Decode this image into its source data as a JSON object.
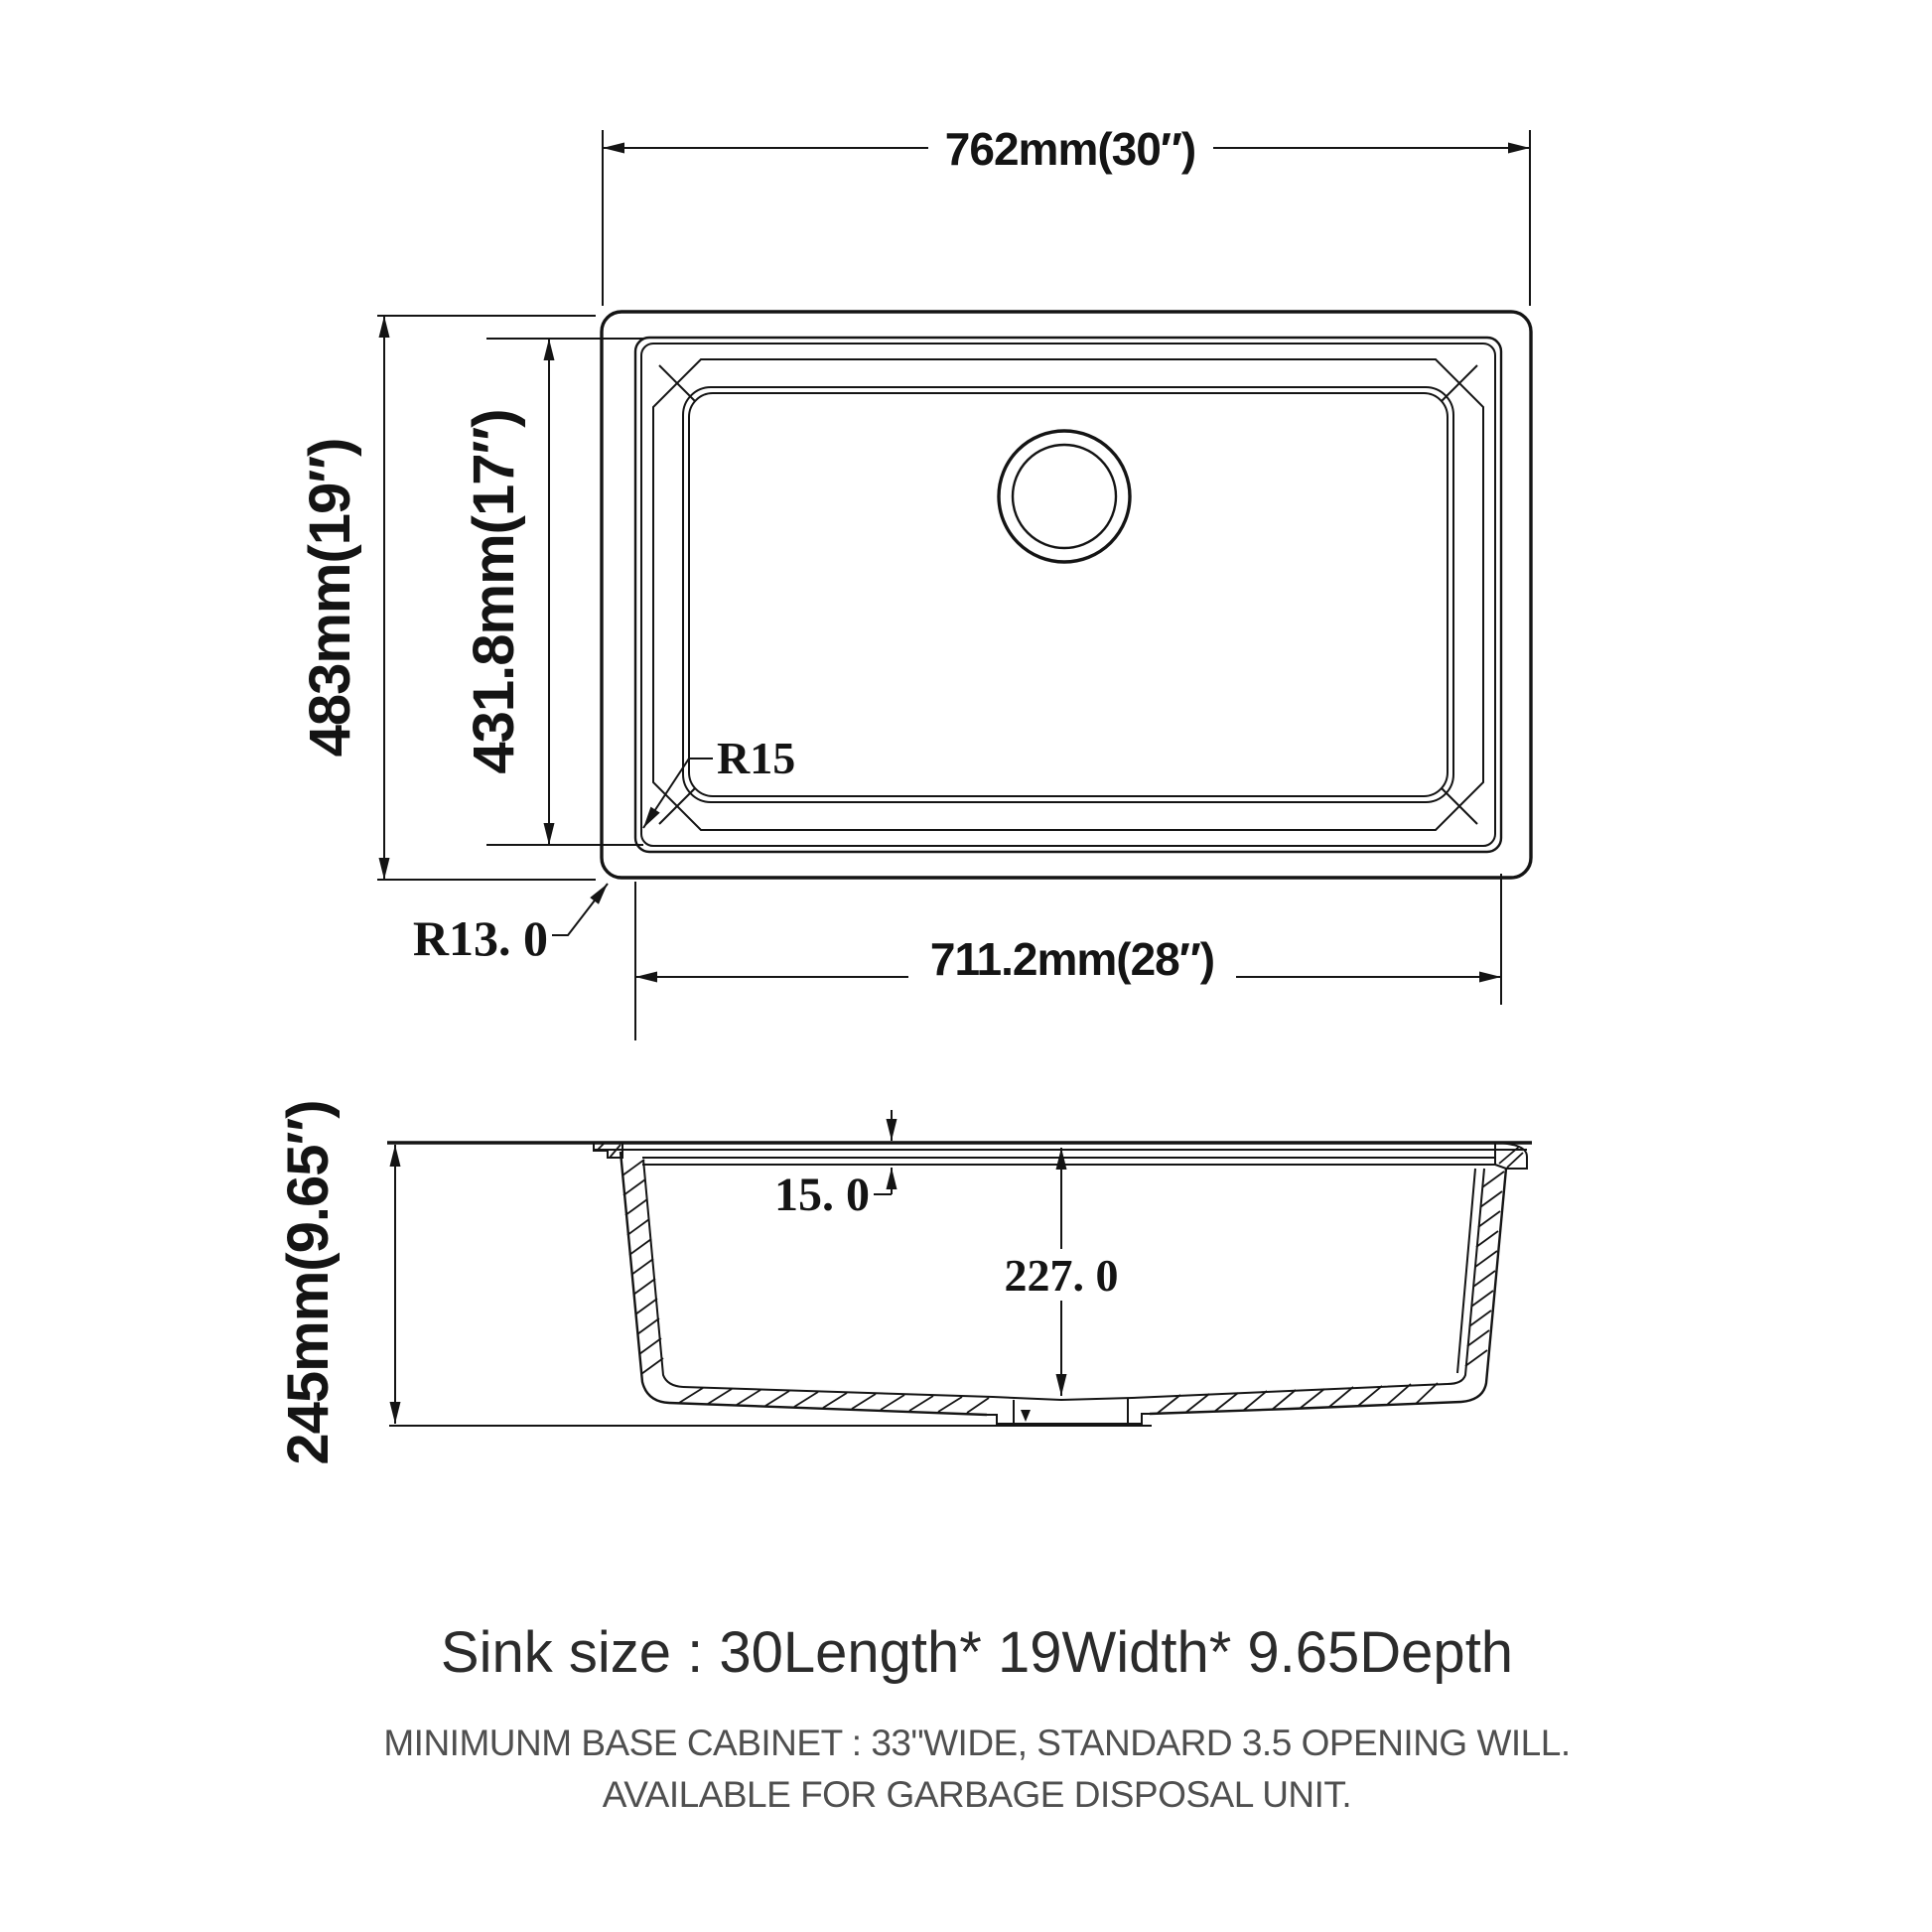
{
  "top_view": {
    "width_label": "762mm(30″)",
    "height_label": "483mm(19″)",
    "inner_height_label": "431.8mm(17″)",
    "inner_width_label": "711.2mm(28″)",
    "inner_corner_radius_label": "R15",
    "outer_corner_radius_label": "R13. 0"
  },
  "side_view": {
    "depth_label": "245mm(9.65″)",
    "rim_offset_label": "15. 0",
    "bowl_depth_label": "227. 0"
  },
  "footer": {
    "size_line": "Sink size  :  30Length* 19Width* 9.65Depth",
    "cabinet_line": "MINIMUNM BASE CABINET : 33\"WIDE,  STANDARD 3.5 OPENING WILL.",
    "disposal_line": "AVAILABLE FOR GARBAGE DISPOSAL UNIT."
  },
  "colors": {
    "line": "#141414",
    "title_text": "#2b2b2b",
    "note_text": "#4f4f4f",
    "background": "#ffffff"
  }
}
